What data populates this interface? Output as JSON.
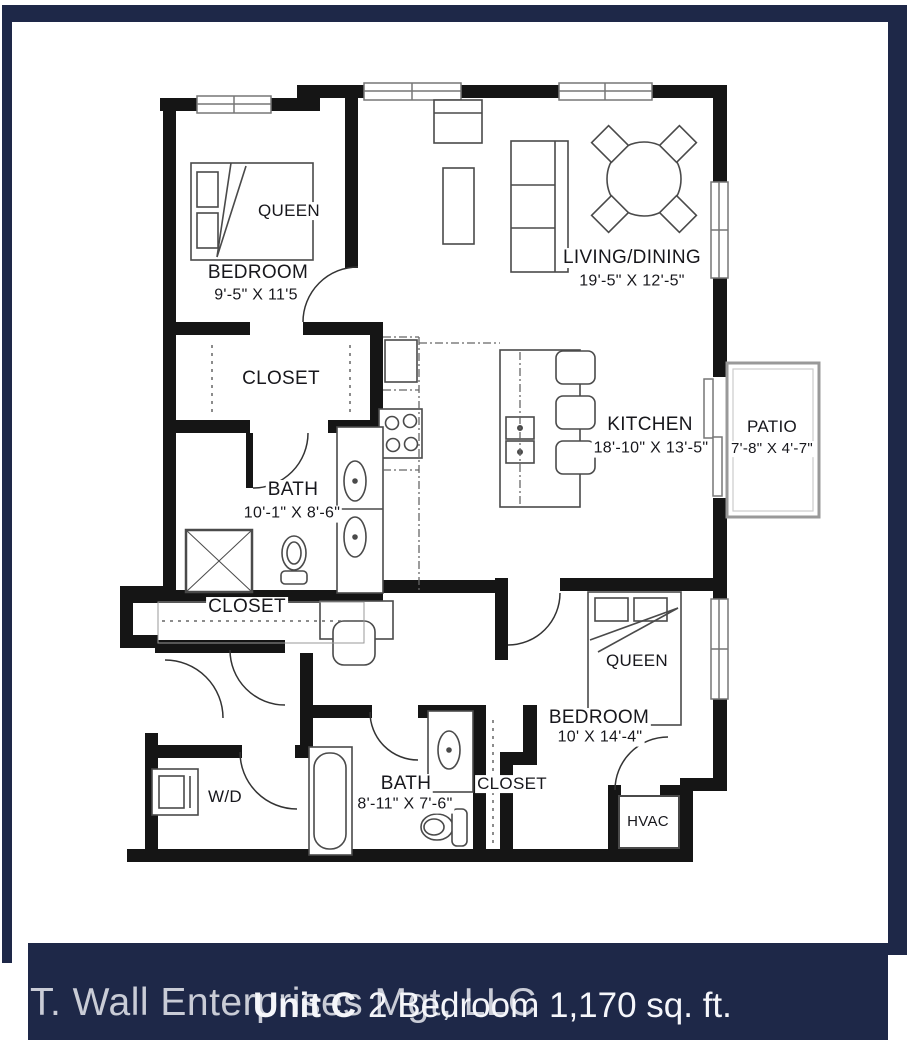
{
  "plan": {
    "rooms": {
      "bedroom1": {
        "name": "BEDROOM",
        "dims": "9'-5\" X 11'5",
        "bed": "QUEEN"
      },
      "living": {
        "name": "LIVING/DINING",
        "dims": "19'-5\" X 12'-5\""
      },
      "closet1": {
        "name": "CLOSET"
      },
      "kitchen": {
        "name": "KITCHEN",
        "dims": "18'-10\" X 13'-5\""
      },
      "patio": {
        "name": "PATIO",
        "dims": "7'-8\" X 4'-7\""
      },
      "bath1": {
        "name": "BATH",
        "dims": "10'-1\" X 8'-6\""
      },
      "closet2": {
        "name": "CLOSET"
      },
      "laundry": {
        "name": "W/D"
      },
      "bath2": {
        "name": "BATH",
        "dims": "8'-11\" X 7'-6\""
      },
      "closet3": {
        "name": "CLOSET"
      },
      "bedroom2": {
        "name": "BEDROOM",
        "dims": "10' X 14'-4\"",
        "bed": "QUEEN"
      },
      "hvac": {
        "name": "HVAC"
      }
    }
  },
  "footer": {
    "company": "T. Wall Enterprises Mgt, LLC",
    "unit": "Unit C",
    "description": "2 Bedroom 1,170 sq. ft."
  },
  "colors": {
    "frame": "#1e2848",
    "band": "#1e2848",
    "company": "#c9ccd6",
    "unit": "#f5f6fa",
    "walls": "#151515"
  }
}
